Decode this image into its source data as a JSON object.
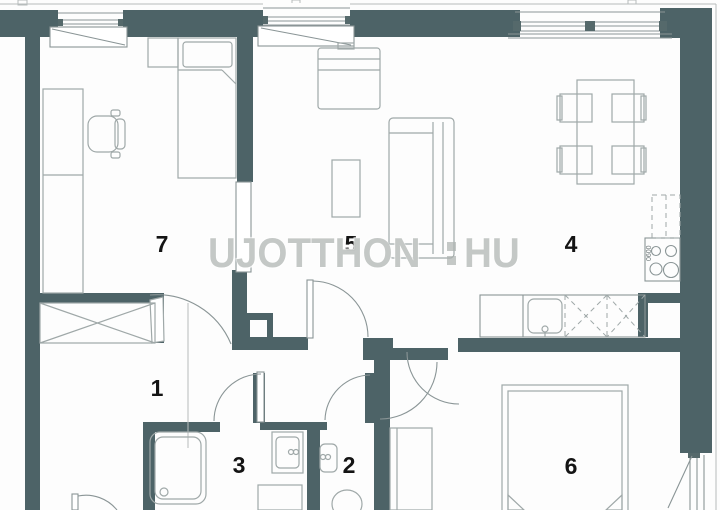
{
  "watermark": {
    "left": "UJOTTHON",
    "right": "HU"
  },
  "rooms": {
    "r1": {
      "number": "1"
    },
    "r2": {
      "number": "2"
    },
    "r3": {
      "number": "3"
    },
    "r4": {
      "number": "4"
    },
    "r5": {
      "number": "5"
    },
    "r6": {
      "number": "6"
    },
    "r7": {
      "number": "7"
    }
  },
  "kitchen": {
    "stove_label": "0600"
  },
  "colors": {
    "wall": "#4d6367",
    "detail_line": "#8a9596",
    "furniture_line": "#9fa8a8",
    "room_number": "#141414",
    "watermark": "#adb3b0"
  }
}
